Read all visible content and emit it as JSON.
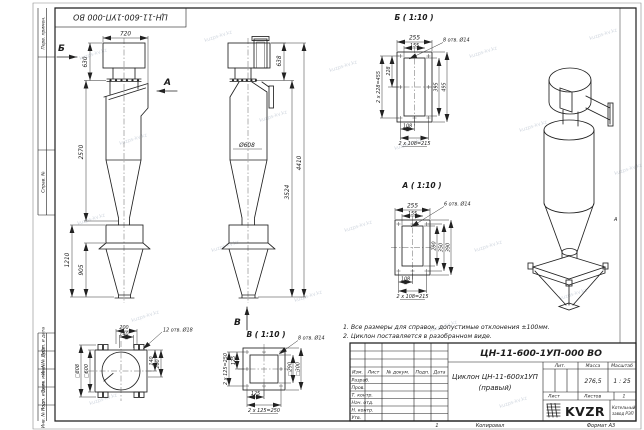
{
  "watermark": "kuzps-kv.kz",
  "frame": {
    "stamp": "ЦН-11-600-1УП-000 ВО",
    "zone_a": "А",
    "label_perv": "Перв. примен.",
    "label_sprav": "Справ. №",
    "label_podp1": "Подп. и дата",
    "label_inv_dubl": "Инв. № дубл.",
    "label_vzam": "Взам. инв. №",
    "label_podp2": "Подп. и дата",
    "label_inv_podl": "Инв. № подл."
  },
  "views": {
    "front": {
      "dim_720": "720",
      "dim_630": "630",
      "dim_2570": "2570",
      "dim_1210": "1210",
      "dim_905": "905",
      "arrow_b": "Б",
      "arrow_a": "А"
    },
    "side": {
      "dim_638": "638",
      "dim_diam": "Ø608",
      "dim_3524": "3524",
      "dim_4410": "4410",
      "arrow_v": "В"
    },
    "detail_b": {
      "title": "Б ( 1:10 )",
      "dim_255": "255",
      "dim_155": "155",
      "dim_228": "228",
      "dim_455": "2 x 228=455",
      "dim_395": "395",
      "dim_495": "495",
      "dim_108": "108",
      "dim_215": "2 x 108=215",
      "callout": "8 отв. Ø14"
    },
    "detail_a": {
      "title": "А ( 1:10 )",
      "dim_255": "255",
      "dim_155": "155",
      "dim_290": "290",
      "dim_350": "350",
      "dim_390": "390",
      "dim_108": "108",
      "dim_215": "2 x 108=215",
      "callout": "6 отв. Ø14"
    },
    "top": {
      "dim_200": "200",
      "dim_140": "140",
      "callout": "12 отв. Ø18",
      "dim_sq808": "□808",
      "dim_sq600": "□600",
      "dim_140r": "140",
      "dim_200r": "200"
    },
    "detail_v": {
      "title": "В ( 1:10 )",
      "dim_125l": "125",
      "dim_250l": "2 x 125=250",
      "dim_sq290": "□290",
      "dim_sq300": "□300",
      "dim_125b": "125",
      "dim_250b": "2 x 125=250",
      "callout": "8 отв. Ø14"
    }
  },
  "notes": {
    "line1": "1. Все размеры для справок, допустимые отклонения ±100мм.",
    "line2": "2. Циклон поставляется в разобранном виде."
  },
  "title_block": {
    "doc_number": "ЦН-11-600-1УП-000 ВО",
    "name_line1": "Циклон ЦН-11-600х1УП",
    "name_line2": "(правый)",
    "col_izm": "Изм.",
    "col_list": "Лист",
    "col_doc": "№ докум.",
    "col_podp": "Подп.",
    "col_data": "Дата",
    "row_razrab": "Разраб.",
    "row_prov": "Пров.",
    "row_tkontr": "Т. контр.",
    "row_nachotd": "Нач. отд.",
    "row_nkontr": "Н. контр.",
    "row_utv": "Утв.",
    "lit": "Лит.",
    "massa": "Масса",
    "masshtab": "Масштаб",
    "massa_value": "276,5",
    "masshtab_value": "1 : 25",
    "list": "Лист",
    "listov": "Листов",
    "listov_value": "1",
    "logo": "KVZR",
    "logo_line1": "Котельный",
    "logo_line2": "завод РЭП",
    "zone": "1",
    "copied": "Копировал",
    "format": "Формат А3"
  }
}
